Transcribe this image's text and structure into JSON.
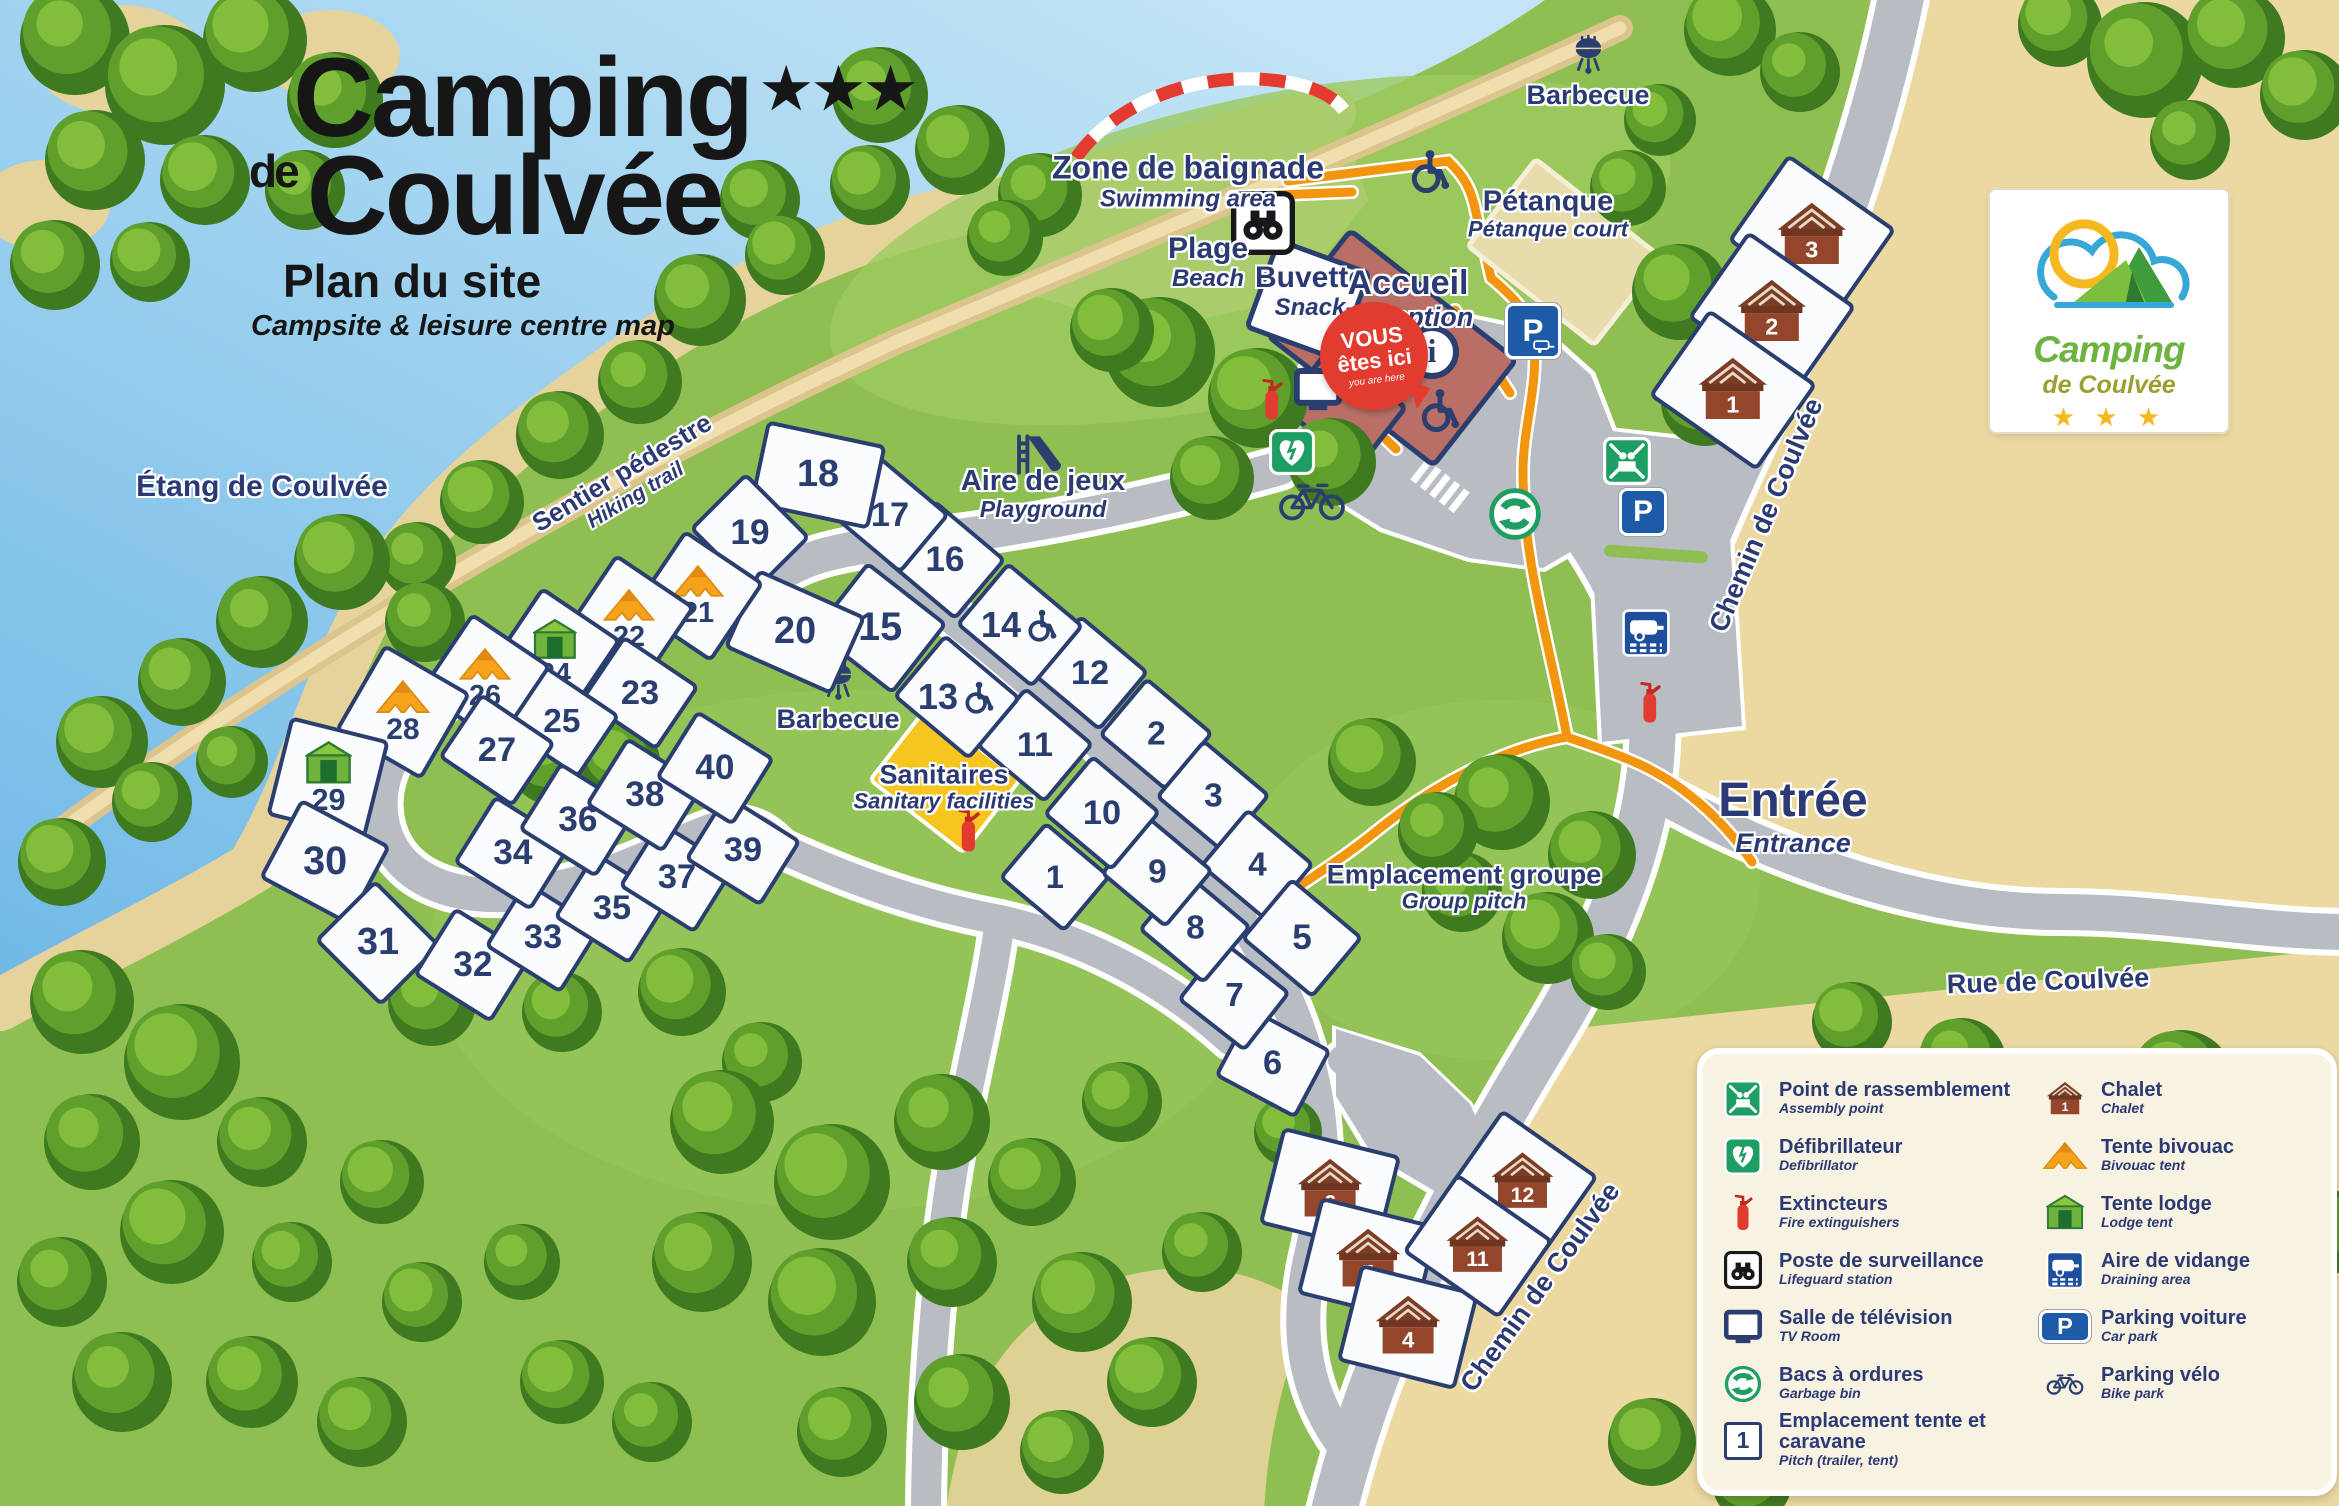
{
  "title": {
    "name": "Camping",
    "stars": "★★★",
    "de": "de",
    "place": "Coulvée",
    "subtitle": "Plan du site",
    "subtitle_en": "Campsite & leisure centre map"
  },
  "logo": {
    "line1": "Camping",
    "line2": "de Coulvée",
    "stars": "★ ★ ★"
  },
  "glyphs": {
    "parking": "P",
    "info": "i",
    "pitch_sample": "1"
  },
  "labels": {
    "etang": {
      "fr": "Étang de Coulvée"
    },
    "sentier": {
      "fr": "Sentier pédestre",
      "en": "Hiking trail"
    },
    "zone_baignade": {
      "fr": "Zone de baignade",
      "en": "Swimming area"
    },
    "plage": {
      "fr": "Plage",
      "en": "Beach"
    },
    "buvette": {
      "fr": "Buvette",
      "en": "Snack"
    },
    "accueil": {
      "fr": "Accueil",
      "en": "Reception"
    },
    "you_are_here": {
      "fr1": "VOUS",
      "fr2": "êtes ici",
      "en": "you are here"
    },
    "petanque": {
      "fr": "Pétanque",
      "en": "Pétanque court"
    },
    "barbecue_nord": {
      "fr": "Barbecue"
    },
    "barbecue_centre": {
      "fr": "Barbecue"
    },
    "aire_de_jeux": {
      "fr": "Aire de jeux",
      "en": "Playground"
    },
    "sanitaires": {
      "fr": "Sanitaires",
      "en": "Sanitary facilities"
    },
    "groupe": {
      "fr": "Emplacement groupe",
      "en": "Group pitch"
    },
    "entree": {
      "fr": "Entrée",
      "en": "Entrance"
    },
    "chemin_haut": {
      "fr": "Chemin de Coulvée"
    },
    "chemin_bas": {
      "fr": "Chemin de Coulvée"
    },
    "rue": {
      "fr": "Rue de Coulvée"
    }
  },
  "legend": {
    "left": [
      {
        "icon": "assembly",
        "fr": "Point de rassemblement",
        "en": "Assembly point"
      },
      {
        "icon": "defib",
        "fr": "Défibrillateur",
        "en": "Defibrillator"
      },
      {
        "icon": "extinguisher",
        "fr": "Extincteurs",
        "en": "Fire extinguishers"
      },
      {
        "icon": "binoculars",
        "fr": "Poste de surveillance",
        "en": "Lifeguard station"
      },
      {
        "icon": "tv",
        "fr": "Salle de télévision",
        "en": "TV Room"
      },
      {
        "icon": "recycle",
        "fr": "Bacs à ordures",
        "en": "Garbage bin"
      },
      {
        "icon": "pitch",
        "fr": "Emplacement tente et caravane",
        "en": "Pitch (trailer, tent)"
      }
    ],
    "right": [
      {
        "icon": "chalet",
        "fr": "Chalet",
        "en": "Chalet"
      },
      {
        "icon": "tent",
        "fr": "Tente bivouac",
        "en": "Bivouac tent"
      },
      {
        "icon": "lodge",
        "fr": "Tente lodge",
        "en": "Lodge tent"
      },
      {
        "icon": "vidange",
        "fr": "Aire de vidange",
        "en": "Draining area"
      },
      {
        "icon": "parking",
        "fr": "Parking voiture",
        "en": "Car park"
      },
      {
        "icon": "bike",
        "fr": "Parking vélo",
        "en": "Bike park"
      }
    ]
  },
  "pitches": [
    {
      "n": 1,
      "x": 1055,
      "y": 877,
      "w": 86,
      "h": 74,
      "r": 40
    },
    {
      "n": 2,
      "x": 1156,
      "y": 734,
      "w": 88,
      "h": 76,
      "r": 40
    },
    {
      "n": 3,
      "x": 1213,
      "y": 796,
      "w": 88,
      "h": 76,
      "r": 40
    },
    {
      "n": 4,
      "x": 1257,
      "y": 865,
      "w": 88,
      "h": 76,
      "r": 40
    },
    {
      "n": 5,
      "x": 1302,
      "y": 938,
      "w": 94,
      "h": 80,
      "r": 40
    },
    {
      "n": 6,
      "x": 1273,
      "y": 1063,
      "w": 92,
      "h": 78,
      "r": 28
    },
    {
      "n": 7,
      "x": 1234,
      "y": 996,
      "w": 86,
      "h": 76,
      "r": 38
    },
    {
      "n": 8,
      "x": 1195,
      "y": 928,
      "w": 86,
      "h": 76,
      "r": 40
    },
    {
      "n": 9,
      "x": 1157,
      "y": 872,
      "w": 86,
      "h": 76,
      "r": 40
    },
    {
      "n": 10,
      "x": 1102,
      "y": 813,
      "w": 90,
      "h": 78,
      "r": 40
    },
    {
      "n": 11,
      "x": 1035,
      "y": 745,
      "w": 90,
      "h": 78,
      "r": 40
    },
    {
      "n": 12,
      "x": 1090,
      "y": 673,
      "w": 90,
      "h": 78,
      "r": 40
    },
    {
      "n": 13,
      "x": 957,
      "y": 697,
      "w": 100,
      "h": 82,
      "r": 40,
      "wc": true
    },
    {
      "n": 14,
      "x": 1020,
      "y": 625,
      "w": 100,
      "h": 82,
      "r": 40,
      "wc": true
    },
    {
      "n": 15,
      "x": 880,
      "y": 628,
      "w": 102,
      "h": 90,
      "r": 38
    },
    {
      "n": 16,
      "x": 945,
      "y": 560,
      "w": 94,
      "h": 80,
      "r": 40
    },
    {
      "n": 17,
      "x": 890,
      "y": 515,
      "w": 92,
      "h": 78,
      "r": 40
    },
    {
      "n": 18,
      "x": 818,
      "y": 475,
      "w": 122,
      "h": 86,
      "r": 12
    },
    {
      "n": 19,
      "x": 750,
      "y": 533,
      "w": 92,
      "h": 80,
      "r": 45
    },
    {
      "n": 20,
      "x": 795,
      "y": 632,
      "w": 118,
      "h": 86,
      "r": 24
    },
    {
      "n": 21,
      "x": 698,
      "y": 596,
      "w": 96,
      "h": 96,
      "r": 34,
      "tent": true
    },
    {
      "n": 22,
      "x": 629,
      "y": 620,
      "w": 96,
      "h": 96,
      "r": 34,
      "tent": true
    },
    {
      "n": 23,
      "x": 640,
      "y": 693,
      "w": 92,
      "h": 78,
      "r": 34
    },
    {
      "n": 24,
      "x": 555,
      "y": 653,
      "w": 96,
      "h": 96,
      "r": 34,
      "lodge": true
    },
    {
      "n": 25,
      "x": 562,
      "y": 722,
      "w": 90,
      "h": 76,
      "r": 34
    },
    {
      "n": 26,
      "x": 485,
      "y": 679,
      "w": 96,
      "h": 96,
      "r": 34,
      "tent": true
    },
    {
      "n": 27,
      "x": 497,
      "y": 750,
      "w": 90,
      "h": 78,
      "r": 34
    },
    {
      "n": 28,
      "x": 403,
      "y": 712,
      "w": 100,
      "h": 100,
      "r": 30,
      "tent": true
    },
    {
      "n": 29,
      "x": 328,
      "y": 778,
      "w": 102,
      "h": 102,
      "r": 14,
      "lodge": true
    },
    {
      "n": 30,
      "x": 325,
      "y": 862,
      "w": 102,
      "h": 90,
      "r": 28
    },
    {
      "n": 31,
      "x": 378,
      "y": 943,
      "w": 94,
      "h": 86,
      "r": 45
    },
    {
      "n": 32,
      "x": 473,
      "y": 965,
      "w": 92,
      "h": 80,
      "r": 32
    },
    {
      "n": 33,
      "x": 543,
      "y": 937,
      "w": 90,
      "h": 78,
      "r": 32
    },
    {
      "n": 34,
      "x": 513,
      "y": 853,
      "w": 92,
      "h": 80,
      "r": 32
    },
    {
      "n": 35,
      "x": 612,
      "y": 908,
      "w": 90,
      "h": 78,
      "r": 32
    },
    {
      "n": 36,
      "x": 578,
      "y": 820,
      "w": 92,
      "h": 80,
      "r": 32
    },
    {
      "n": 37,
      "x": 677,
      "y": 877,
      "w": 90,
      "h": 78,
      "r": 32
    },
    {
      "n": 38,
      "x": 645,
      "y": 795,
      "w": 92,
      "h": 80,
      "r": 32
    },
    {
      "n": 39,
      "x": 743,
      "y": 850,
      "w": 90,
      "h": 78,
      "r": 32
    },
    {
      "n": 40,
      "x": 715,
      "y": 768,
      "w": 92,
      "h": 80,
      "r": 32
    }
  ],
  "chalets": [
    {
      "n": 3,
      "x": 1812,
      "y": 235,
      "w": 132,
      "h": 106,
      "r": 35
    },
    {
      "n": 2,
      "x": 1772,
      "y": 312,
      "w": 132,
      "h": 106,
      "r": 35
    },
    {
      "n": 1,
      "x": 1733,
      "y": 390,
      "w": 132,
      "h": 106,
      "r": 35
    },
    {
      "n": 6,
      "x": 1330,
      "y": 1190,
      "w": 122,
      "h": 100,
      "r": 14
    },
    {
      "n": 5,
      "x": 1368,
      "y": 1260,
      "w": 122,
      "h": 100,
      "r": 14
    },
    {
      "n": 4,
      "x": 1408,
      "y": 1327,
      "w": 122,
      "h": 100,
      "r": 14
    },
    {
      "n": 12,
      "x": 1523,
      "y": 1182,
      "w": 118,
      "h": 96,
      "r": 35,
      "wc": true
    },
    {
      "n": 11,
      "x": 1478,
      "y": 1246,
      "w": 118,
      "h": 96,
      "r": 35,
      "wc": true
    }
  ],
  "colors": {
    "water_light": "#C2E4F6",
    "water_deep": "#6FB9E6",
    "grass": "#8FBE52",
    "grass_light": "#9CCB5F",
    "sand": "#ECD9A2",
    "beach": "#E6D39B",
    "road": "#B8BDC3",
    "path_orange": "#F2950F",
    "navy": "#2B3E70",
    "red": "#E23B30",
    "sign_green": "#1E9E63",
    "sign_blue": "#1D5BA8",
    "chalet_brown": "#93462B",
    "tent_orange": "#F6A21B",
    "lodge_green": "#6FB33C",
    "sanitary_yellow": "#F6C51F",
    "reception": "#B96F66",
    "legend_bg": "#F8F2E2"
  }
}
